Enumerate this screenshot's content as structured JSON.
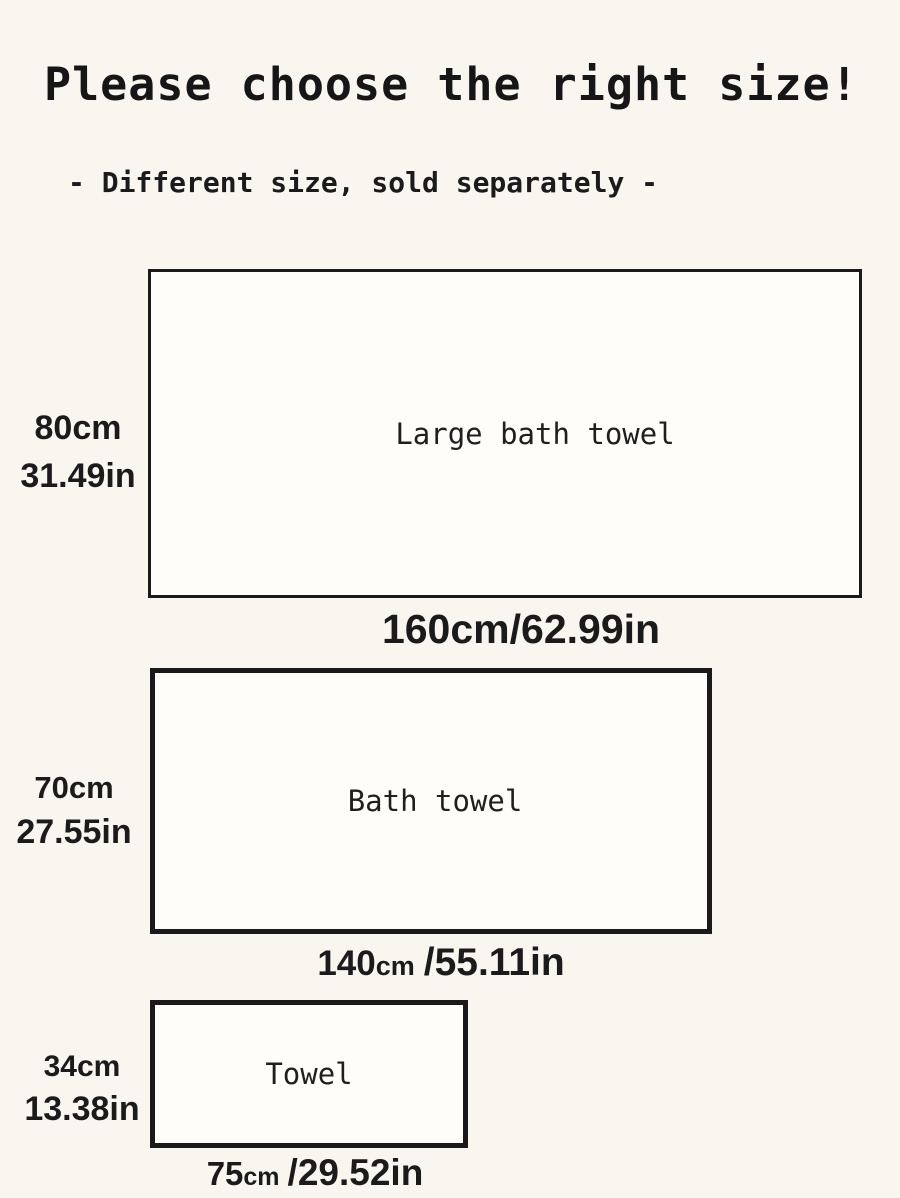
{
  "colors": {
    "background": "#f8f6ef",
    "ink": "#1b1b1b",
    "rect_fill": "#fefdfa",
    "rect_border": "#1a1a1a"
  },
  "header": {
    "title": "Please choose the right size!",
    "subtitle": "- Different size, sold separately -"
  },
  "towels": [
    {
      "name": "Large bath towel",
      "height_cm": "80cm",
      "height_in": "31.49in",
      "width_cm_value": "160",
      "width_cm_unit": "cm",
      "width_in": "/62.99in"
    },
    {
      "name": "Bath towel",
      "height_cm": "70cm",
      "height_in": "27.55in",
      "width_cm_value": "140",
      "width_cm_unit": "cm",
      "width_in": "/55.11in"
    },
    {
      "name": "Towel",
      "height_cm": "34cm",
      "height_in": "13.38in",
      "width_cm_value": "75",
      "width_cm_unit": "cm",
      "width_in": "/29.52in"
    }
  ]
}
